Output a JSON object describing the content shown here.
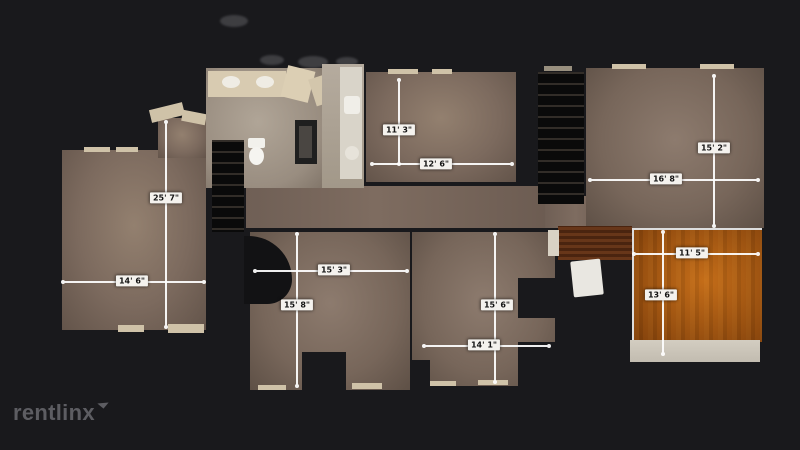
{
  "watermark": {
    "text": "rentlinx"
  },
  "rooms": [
    {
      "name": "left-room",
      "height": "25' 7\"",
      "width": "14' 6\""
    },
    {
      "name": "top-middle-room",
      "height": "11' 3\"",
      "width": "12' 6\""
    },
    {
      "name": "top-right-room",
      "height": "15' 2\"",
      "width": "16' 8\""
    },
    {
      "name": "bottom-left-room",
      "height": "15' 8\"",
      "width": "15' 3\""
    },
    {
      "name": "bottom-middle-room",
      "height": "15' 6\"",
      "width": "14' 1\""
    },
    {
      "name": "wood-floor-room",
      "height": "13' 6\"",
      "width": "11' 5\""
    }
  ],
  "colors": {
    "background": "#19191c",
    "carpet": "#7c6a5e",
    "bathroom_floor": "#a89d90",
    "wood_floor": "#a9601c",
    "dimension_line": "#ffffff",
    "label_background": "#f4f2ee",
    "label_text": "#151515",
    "logo": "#5d5d62"
  }
}
